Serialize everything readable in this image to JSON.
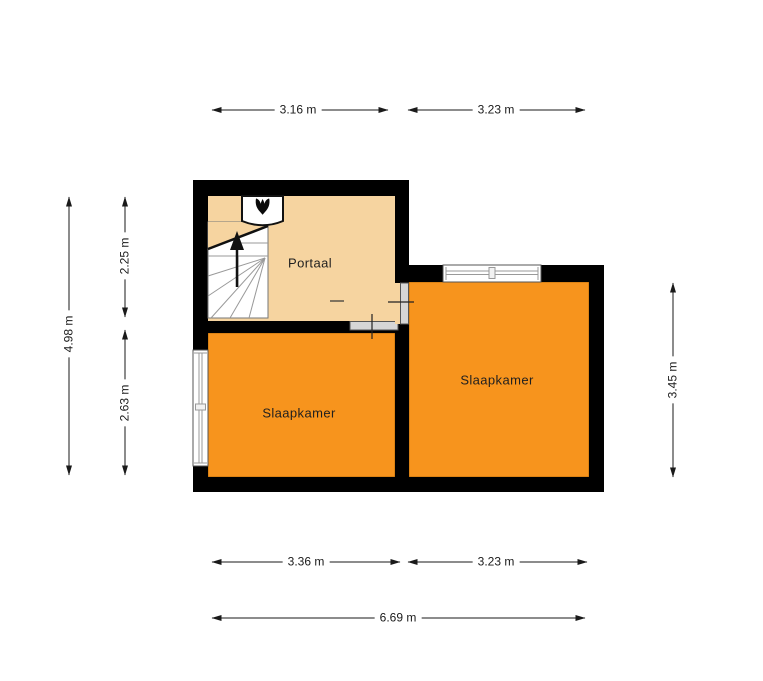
{
  "floorplan": {
    "rooms": {
      "portaal": {
        "label": "Portaal"
      },
      "slaapkamer_left": {
        "label": "Slaapkamer"
      },
      "slaapkamer_right": {
        "label": "Slaapkamer"
      }
    },
    "dimensions": {
      "top": [
        {
          "label": "3.16 m"
        },
        {
          "label": "3.23 m"
        }
      ],
      "left_total": {
        "label": "4.98 m"
      },
      "left_segments": [
        {
          "label": "2.25 m"
        },
        {
          "label": "2.63 m"
        }
      ],
      "right": {
        "label": "3.45 m"
      },
      "bottom_segments": [
        {
          "label": "3.36 m"
        },
        {
          "label": "3.23 m"
        }
      ],
      "bottom_total": {
        "label": "6.69 m"
      }
    },
    "colors": {
      "wall": "#000000",
      "portaal_floor": "#F6D4A0",
      "bedroom_floor": "#F7941D",
      "door": "#D6D6D6",
      "stair_fill": "#FFFFFF",
      "dimension_line": "#1A1A1A"
    },
    "icons": {
      "boiler": "flame-icon",
      "stairs_direction": "arrow-up-icon"
    }
  }
}
